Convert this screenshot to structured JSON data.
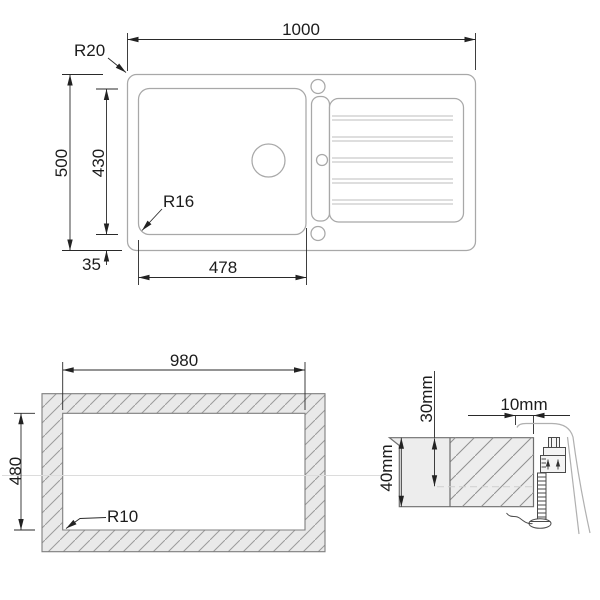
{
  "colors": {
    "background": "#ffffff",
    "outline_gray": "#a8a8a8",
    "dimension_dark": "#222222",
    "hatch_fill": "#e9e9e9",
    "hatch_line": "#9b9b9b"
  },
  "top_view": {
    "overall_width_label": "1000",
    "overall_depth_label": "500",
    "bowl_depth_label": "430",
    "bowl_width_label": "478",
    "edge_offset_label": "35",
    "outer_radius_label": "R20",
    "bowl_radius_label": "R16"
  },
  "cutout_view": {
    "cutout_width_label": "980",
    "cutout_depth_label": "480",
    "cutout_radius_label": "R10"
  },
  "section_view": {
    "overhang_label": "10mm",
    "fixing_depth_label": "30mm",
    "worktop_thickness_label": "40mm"
  }
}
